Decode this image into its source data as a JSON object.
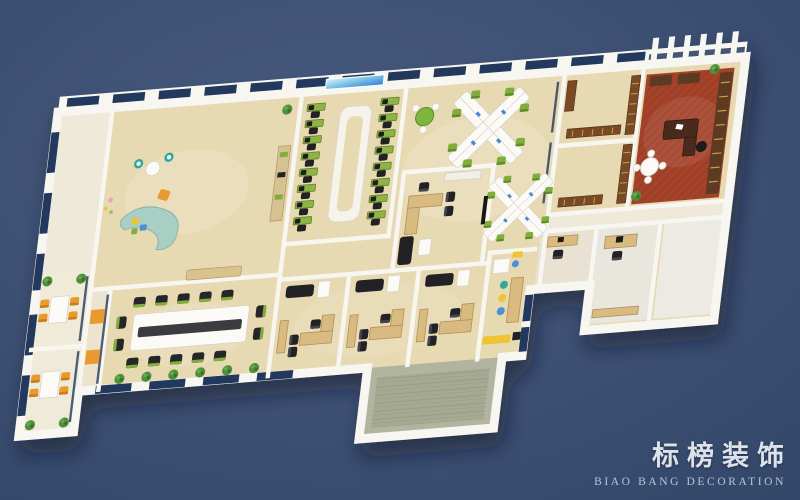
{
  "watermark": {
    "title_cn": "标榜装饰",
    "subtitle_en": "BIAO BANG DECORATION"
  },
  "palette": {
    "bg_top": "#495c80",
    "bg_bottom": "#334769",
    "wall": "#f7f6f1",
    "floor": "#e7d9b2",
    "floor_light": "#efe9d9",
    "glass": "#24395c",
    "green": "#7fae3b",
    "teal": "#a9cec3",
    "orange": "#e89a2f",
    "carpet": "#a5432a",
    "terrace": "#b2b4a0",
    "wood": "#d9bb82",
    "wood_dark": "#5d3a24",
    "black": "#232326",
    "white_furn": "#fbfaf6",
    "blue": "#4a90d9",
    "yellow": "#f0c330"
  },
  "scene": {
    "type": "3d-office-floor-plan-rendering",
    "rooms": [
      "entry-hall",
      "small-meeting-room-1",
      "small-meeting-room-2",
      "reception-lounge",
      "conference-room",
      "training-room",
      "manager-office",
      "open-office",
      "private-office-1",
      "private-office-2",
      "private-office-3",
      "pantry",
      "terrace",
      "library-1",
      "library-2",
      "executive-office",
      "staff-room-1",
      "staff-room-2",
      "staff-room-3",
      "corridor"
    ]
  }
}
